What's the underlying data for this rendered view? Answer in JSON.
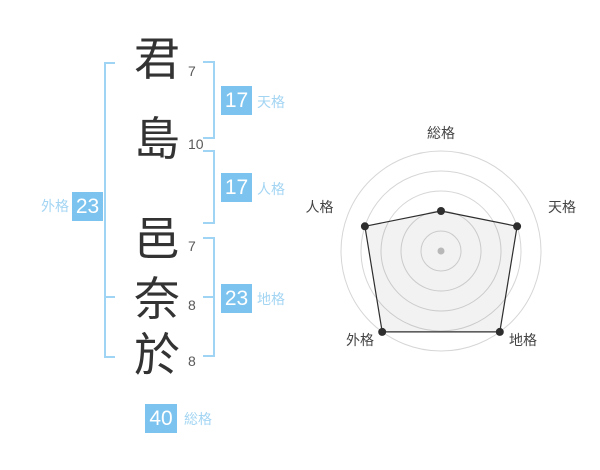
{
  "name": {
    "chars": [
      {
        "char": "君",
        "strokes": "7",
        "group": "surname"
      },
      {
        "char": "島",
        "strokes": "10",
        "group": "surname"
      },
      {
        "char": "邑",
        "strokes": "7",
        "group": "given"
      },
      {
        "char": "奈",
        "strokes": "8",
        "group": "given"
      },
      {
        "char": "於",
        "strokes": "8",
        "group": "given"
      }
    ]
  },
  "kaku": {
    "tenkaku": {
      "label": "天格",
      "value": "17"
    },
    "jinkaku": {
      "label": "人格",
      "value": "17"
    },
    "chikaku": {
      "label": "地格",
      "value": "23"
    },
    "gaikaku": {
      "label": "外格",
      "value": "23"
    },
    "soukaku": {
      "label": "総格",
      "value": "40"
    }
  },
  "chart_data": {
    "type": "radar",
    "axes": [
      "総格",
      "天格",
      "地格",
      "外格",
      "人格"
    ],
    "values": [
      40,
      80,
      100,
      100,
      80
    ],
    "max": 100,
    "rings": [
      20,
      40,
      60,
      80,
      100
    ],
    "grid": "concentric-circles",
    "legend": "none"
  },
  "colors": {
    "box_blue": "#7cc4ef",
    "label_blue": "#a3d5f3",
    "bracket_blue": "#9fd4f5",
    "kanji_ink": "#333333",
    "stroke_digit": "#595959",
    "ring_gray": "#d6d6d6",
    "polygon_line": "#2e2e2e",
    "center_dot": "#b8b8b8",
    "chart_label": "#444444"
  }
}
